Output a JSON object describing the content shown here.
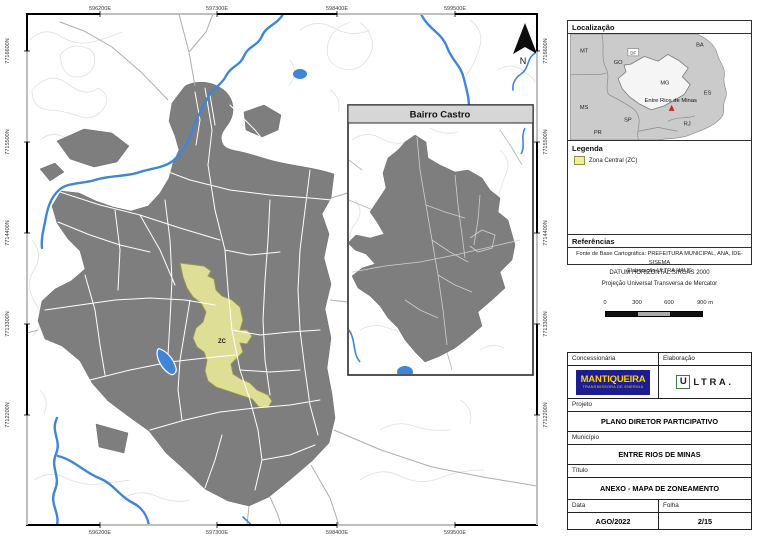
{
  "map": {
    "easting": [
      "596200E",
      "597300E",
      "598400E",
      "599500E"
    ],
    "northing": [
      "7716600N",
      "7715500N",
      "7714400N",
      "7713300N",
      "7712200N"
    ],
    "zone_label": "ZC",
    "north_label": "N",
    "inset_title": "Bairro Castro"
  },
  "localizacao": {
    "title": "Localização",
    "states": [
      "MT",
      "GO",
      "DF",
      "BA",
      "MG",
      "ES",
      "MS",
      "SP",
      "RJ",
      "PR"
    ],
    "marker_label": "Entre Rios de Minas"
  },
  "legenda": {
    "title": "Legenda",
    "items": [
      {
        "label": "Zona Central (ZC)",
        "color": "#f0ee9b"
      }
    ]
  },
  "referencias": {
    "title": "Referências",
    "fonte": "Fonte de Base Cartográfica: PREFEITURA MUNICIPAL, ANA, IDE-SISEMA",
    "elaboracao": "Elaboração ULTRA HAUS"
  },
  "projecao": {
    "datum": "DATUM HORIZONTAL:SIRGAS 2000",
    "sistema": "Projeção Universal Transversa de Mercator"
  },
  "scalebar": {
    "ticks": [
      "0",
      "300",
      "600",
      "900 m"
    ]
  },
  "titleblock": {
    "concessionaria_label": "Concessionária",
    "elaboracao_label": "Elaboração",
    "projeto_label": "Projeto",
    "projeto": "PLANO DIRETOR PARTICIPATIVO",
    "municipio_label": "Município",
    "municipio": "ENTRE RIOS DE MINAS",
    "titulo_label": "Título",
    "titulo": "ANEXO - MAPA DE ZONEAMENTO",
    "data_label": "Data",
    "data": "AGO/2022",
    "folha_label": "Folha",
    "folha": "2/15",
    "logos": {
      "mantiqueira_name": "MANTIQUEIRA",
      "mantiqueira_sub": "TRANSMISSORA DE ENERGIA",
      "ultra_u": "U",
      "ultra_rest": "LTRA."
    }
  },
  "colors": {
    "urban": "#7e7e7e",
    "zona_central": "#f0ee9b",
    "water": "#3f86d8",
    "contour": "#e0e0e0",
    "mantiqueira_bg": "#1c1d8f",
    "mantiqueira_text": "#ffd200",
    "ultra_green": "#3d7a3d",
    "marker_red": "#cc2222"
  }
}
